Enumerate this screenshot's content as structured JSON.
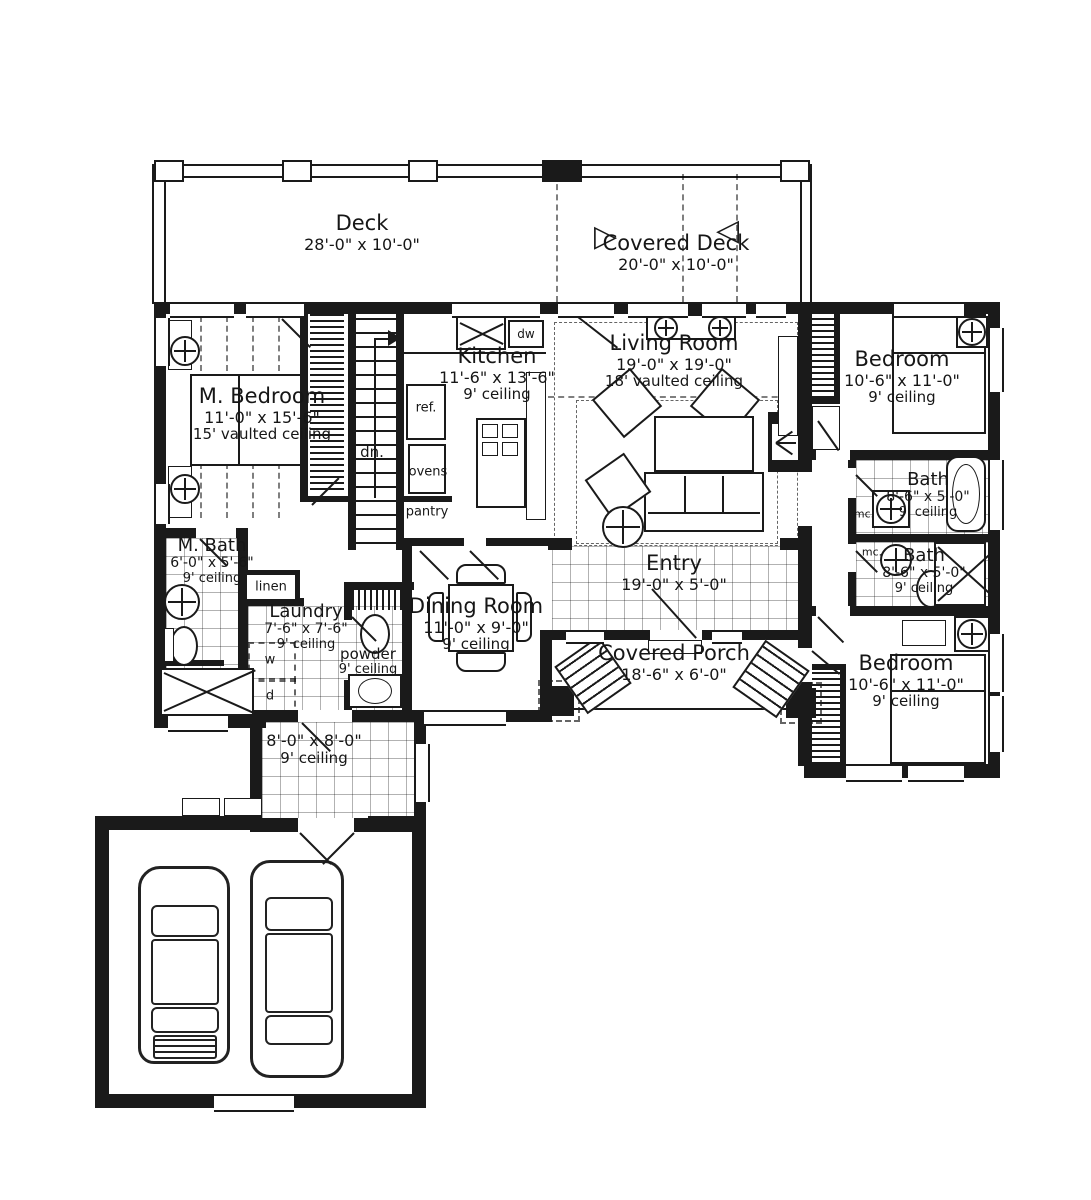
{
  "plan_title": "First Floor Plan",
  "colors": {
    "ink": "#1a1a1a",
    "paper": "#ffffff"
  },
  "rooms": {
    "deck": {
      "name": "Deck",
      "dims": "28'-0\" x 10'-0\"",
      "ceiling": ""
    },
    "coveredDeck": {
      "name": "Covered Deck",
      "dims": "20'-0\" x 10'-0\"",
      "ceiling": ""
    },
    "mBedroom": {
      "name": "M. Bedroom",
      "dims": "11'-0\" x 15'-6\"",
      "ceiling": "15' vaulted ceiling"
    },
    "kitchen": {
      "name": "Kitchen",
      "dims": "11'-6\" x 13'-6\"",
      "ceiling": "9' ceiling"
    },
    "livingRoom": {
      "name": "Living Room",
      "dims": "19'-0\" x 19'-0\"",
      "ceiling": "18' vaulted ceiling"
    },
    "bedroomUpper": {
      "name": "Bedroom",
      "dims": "10'-6\" x 11'-0\"",
      "ceiling": "9' ceiling"
    },
    "bathUpper": {
      "name": "Bath",
      "dims": "8'-6\" x 5'-0\"",
      "ceiling": "9' ceiling"
    },
    "bathLower": {
      "name": "Bath",
      "dims": "8'-6\" x 5'-0\"",
      "ceiling": "9' ceiling"
    },
    "bedroomLower": {
      "name": "Bedroom",
      "dims": "10'-6\" x 11'-0\"",
      "ceiling": "9' ceiling"
    },
    "mBath": {
      "name": "M. Bath",
      "dims": "6'-0\" x 5'-6\"",
      "ceiling": "9' ceiling"
    },
    "laundry": {
      "name": "Laundry",
      "dims": "7'-6\" x 7'-6\"",
      "ceiling": "9' ceiling"
    },
    "powder": {
      "name": "powder",
      "dims": "",
      "ceiling": "9' ceiling"
    },
    "diningRoom": {
      "name": "Dining Room",
      "dims": "11'-0\" x 9'-0\"",
      "ceiling": "9' ceiling"
    },
    "entry": {
      "name": "Entry",
      "dims": "19'-0\" x 5'-0\"",
      "ceiling": ""
    },
    "coveredPorch": {
      "name": "Covered Porch",
      "dims": "18'-6\" x 6'-0\"",
      "ceiling": ""
    },
    "mudHall": {
      "name": "",
      "dims": "8'-0\" x 8'-0\"",
      "ceiling": "9' ceiling"
    }
  },
  "fixtures": {
    "ref": "ref.",
    "ovens": "ovens",
    "pantry": "pantry",
    "down": "dn.",
    "linen": "linen",
    "washer": "w",
    "dryer": "d",
    "dishwasher": "dw",
    "mc_upper": "mc.",
    "mc_lower": "mc."
  },
  "symbols": {
    "triangle_right": "▷",
    "triangle_left": "◁"
  }
}
